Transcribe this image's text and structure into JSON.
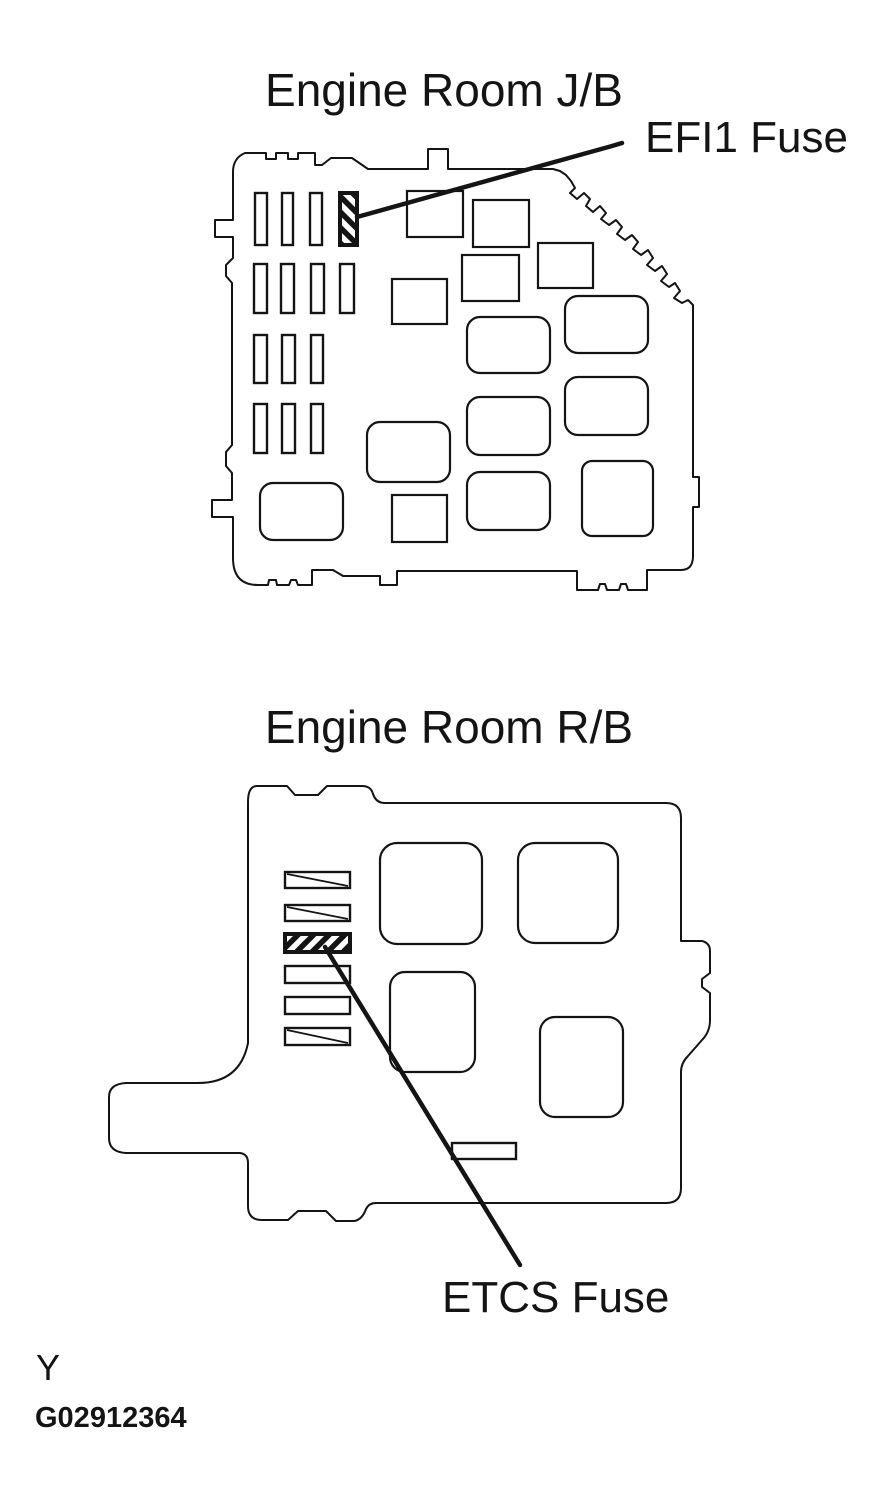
{
  "colors": {
    "paper": "#ffffff",
    "ink": "#141414"
  },
  "jb": {
    "title": "Engine Room J/B",
    "fuse_label": "EFI1 Fuse"
  },
  "rb": {
    "title": "Engine Room R/B",
    "fuse_label": "ETCS Fuse"
  },
  "footer": {
    "marker": "Y",
    "figure_id": "G02912364"
  }
}
